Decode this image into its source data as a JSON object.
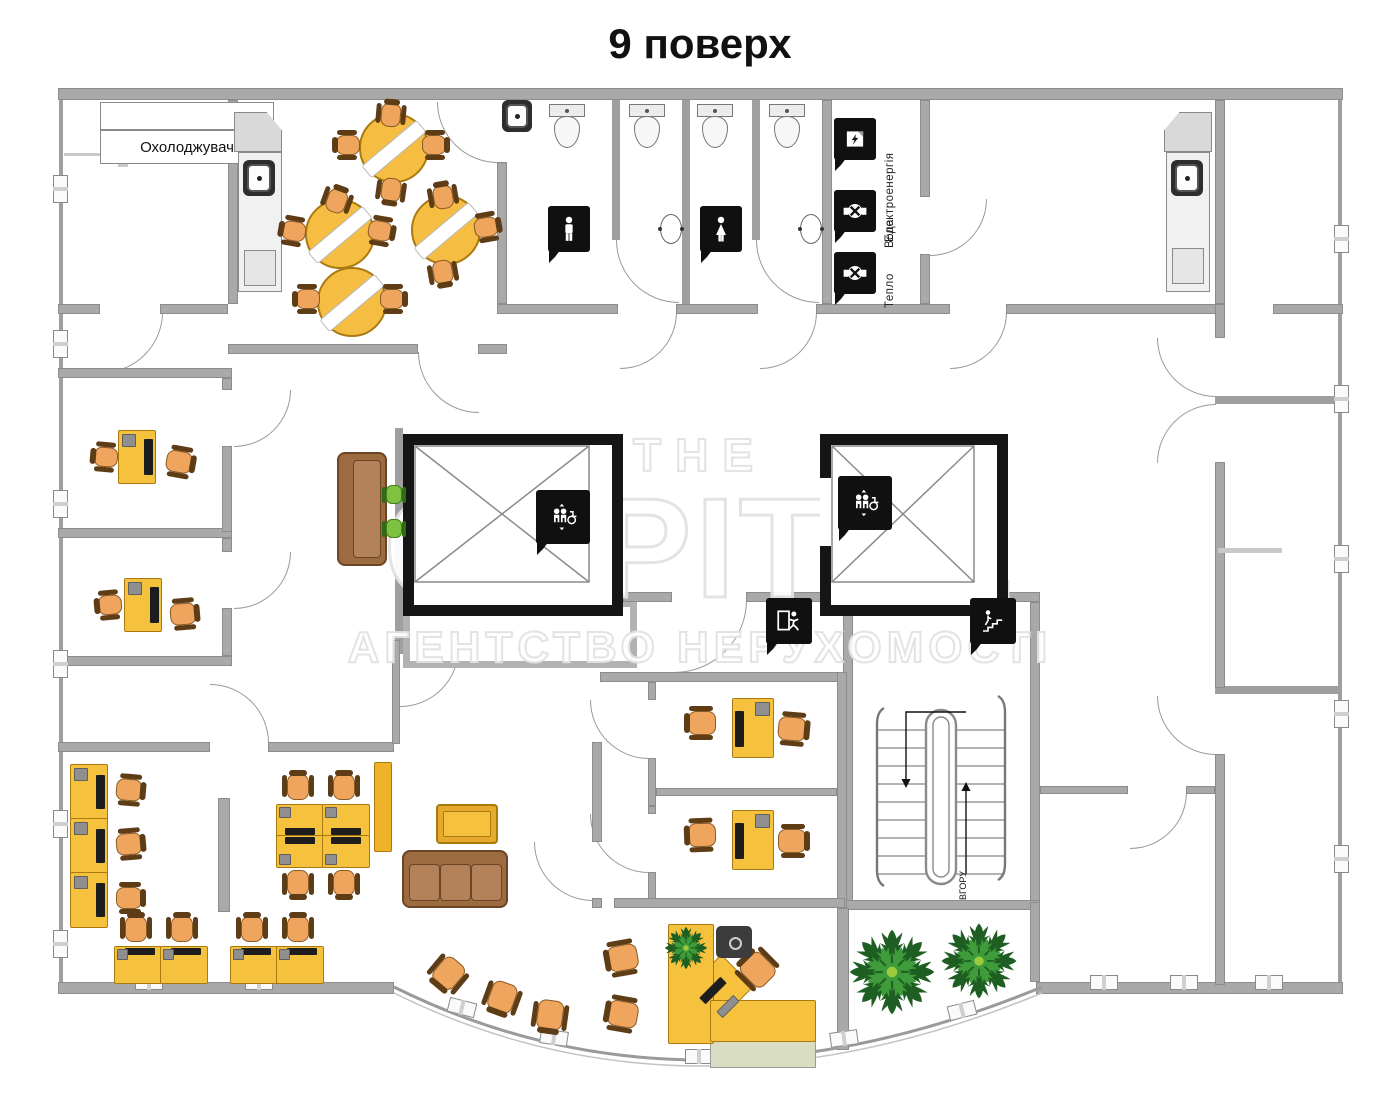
{
  "page": {
    "title": "9 поверх"
  },
  "floor_plan": {
    "cooler_label": "Охолоджувач",
    "stairs": {
      "up_label": "ВГОРУ"
    },
    "utilities": {
      "electricity": "Електроенергія",
      "water": "Вода",
      "heat": "Тепло"
    },
    "icons": [
      "wc-men-icon",
      "wc-women-icon",
      "elevator-icon",
      "exit-icon",
      "stairs-icon",
      "electric-meter-icon",
      "water-valve-icon",
      "heat-valve-icon"
    ]
  },
  "watermark": {
    "line1": "THE",
    "line2": "CAPITAL",
    "line3": "АГЕНТСТВО НЕРУХОМОСТІ"
  },
  "colors": {
    "wall": "#a9a9a9",
    "shaft": "#151515",
    "desk_yellow": "#f6c23e",
    "chair_orange": "#efa55e",
    "chair_trim": "#5d3c16",
    "sofa_brown": "#9c6b3f",
    "green_chair": "#7fc241",
    "table_yellow": "#f5bd41",
    "plant_green": "#1e5e22",
    "counter_shelf": "#d9ddc2"
  }
}
